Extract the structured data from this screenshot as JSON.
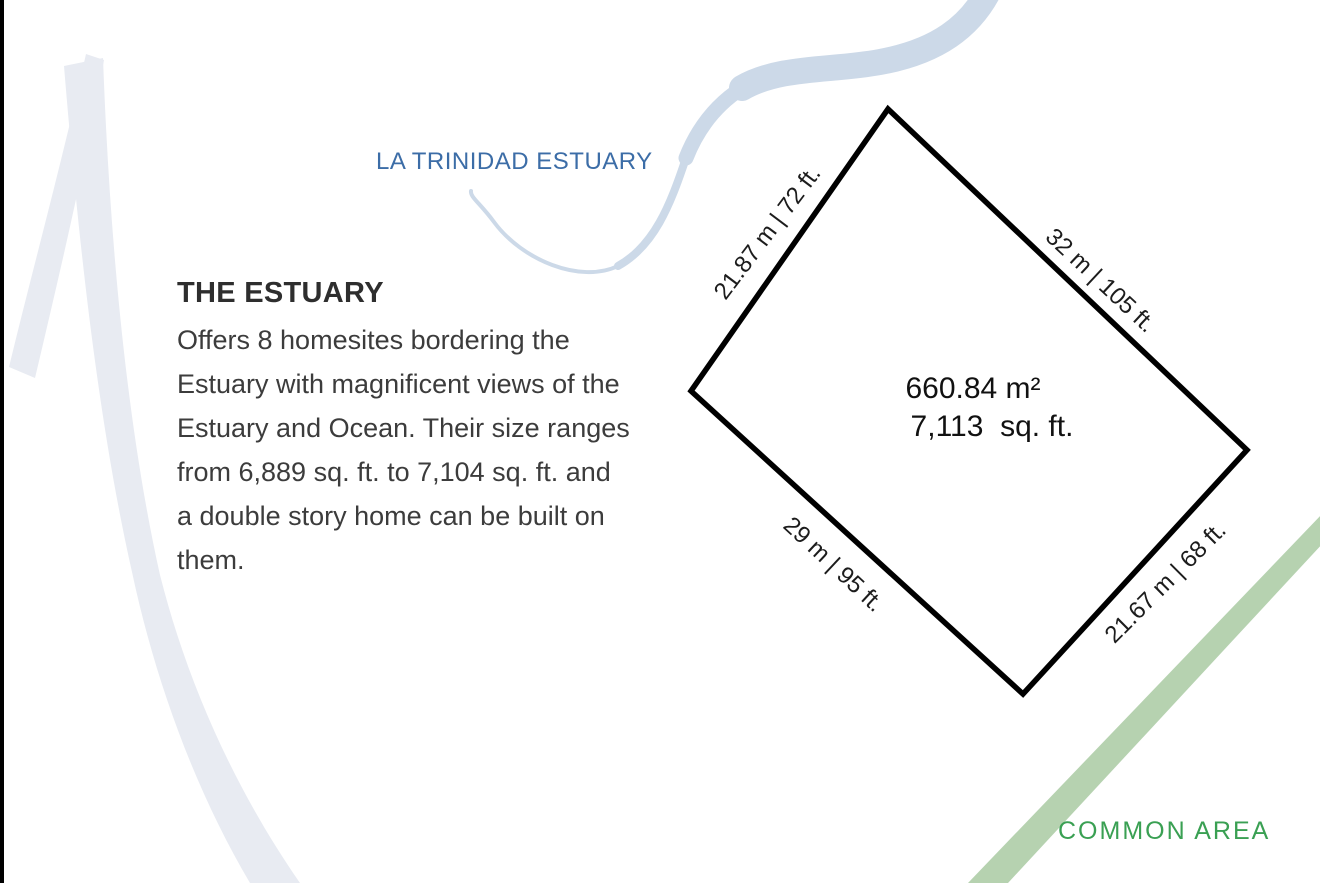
{
  "page": {
    "estuary_title": "LA TRINIDAD ESTUARY",
    "common_area_label": "COMMON AREA"
  },
  "description": {
    "heading": "THE ESTUARY",
    "body": "Offers 8 homesites bordering the\nEstuary with magnificent views of the\nEstuary and Ocean. Their size ranges\nfrom 6,889 sq. ft. to 7,104 sq. ft. and\na double story home can be built on\nthem."
  },
  "lot": {
    "area_m2": "660.84 m²",
    "area_sqft": "7,113  sq. ft.",
    "sides": {
      "northwest": "21.87 m | 72 ft.",
      "northeast": "32 m | 105 ft.",
      "southwest": "29 m | 95 ft.",
      "southeast": "21.67 m | 68 ft."
    }
  },
  "colors": {
    "estuary_text": "#3c6da7",
    "river": "#ccd9e8",
    "watermark": "#e8ebf2",
    "common_area_text": "#3aa053",
    "common_area_stripe": "#b6d2b0",
    "lot_outline": "#000000"
  }
}
